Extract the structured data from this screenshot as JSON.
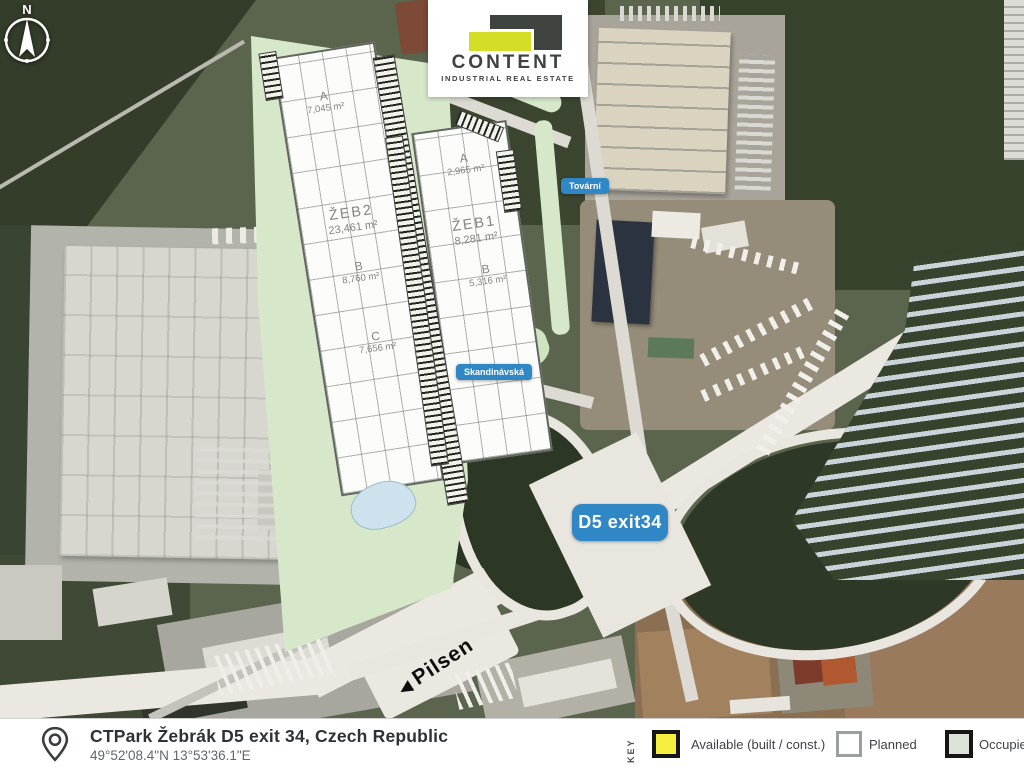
{
  "compass": {
    "north_label": "N"
  },
  "logo": {
    "name": "CONTENT",
    "tagline": "INDUSTRIAL REAL ESTATE"
  },
  "plan": {
    "left_building": {
      "section_a_label": "A",
      "section_a_area": "7,045 m²",
      "name": "ŽEB2",
      "name_area": "23,461 m²",
      "section_b_label": "B",
      "section_b_area": "8,760 m²",
      "section_c_label": "C",
      "section_c_area": "7,656 m²"
    },
    "right_building": {
      "section_a_label": "A",
      "section_a_area": "2,965 m²",
      "name": "ŽEB1",
      "name_area": "8,281 m²",
      "section_b_label": "B",
      "section_b_area": "5,316 m²"
    }
  },
  "road_labels": {
    "tovarni": "Tovární",
    "skandinavska": "Skandinávská",
    "d5_exit": "D5 exit34"
  },
  "direction": {
    "arrow": "◀",
    "label": "Pilsen"
  },
  "footer": {
    "title": "CTPark Žebrák D5 exit 34, Czech Republic",
    "coordinates": "49°52'08.4\"N 13°53'36.1\"E",
    "key_label": "KEY",
    "legend": [
      {
        "label": "Available (built / const.)",
        "color": "#f6ef3d",
        "border": "#161616"
      },
      {
        "label": "Planned",
        "color": "#ffffff",
        "border": "#9aa09f"
      },
      {
        "label": "Occupied",
        "color": "#dee3da",
        "border": "#161616"
      }
    ]
  },
  "colors": {
    "badge_blue": "#2f87c6",
    "plan_green": "#d7e8ca",
    "logo_yellow": "#d4de27",
    "logo_dark": "#3e4340"
  }
}
